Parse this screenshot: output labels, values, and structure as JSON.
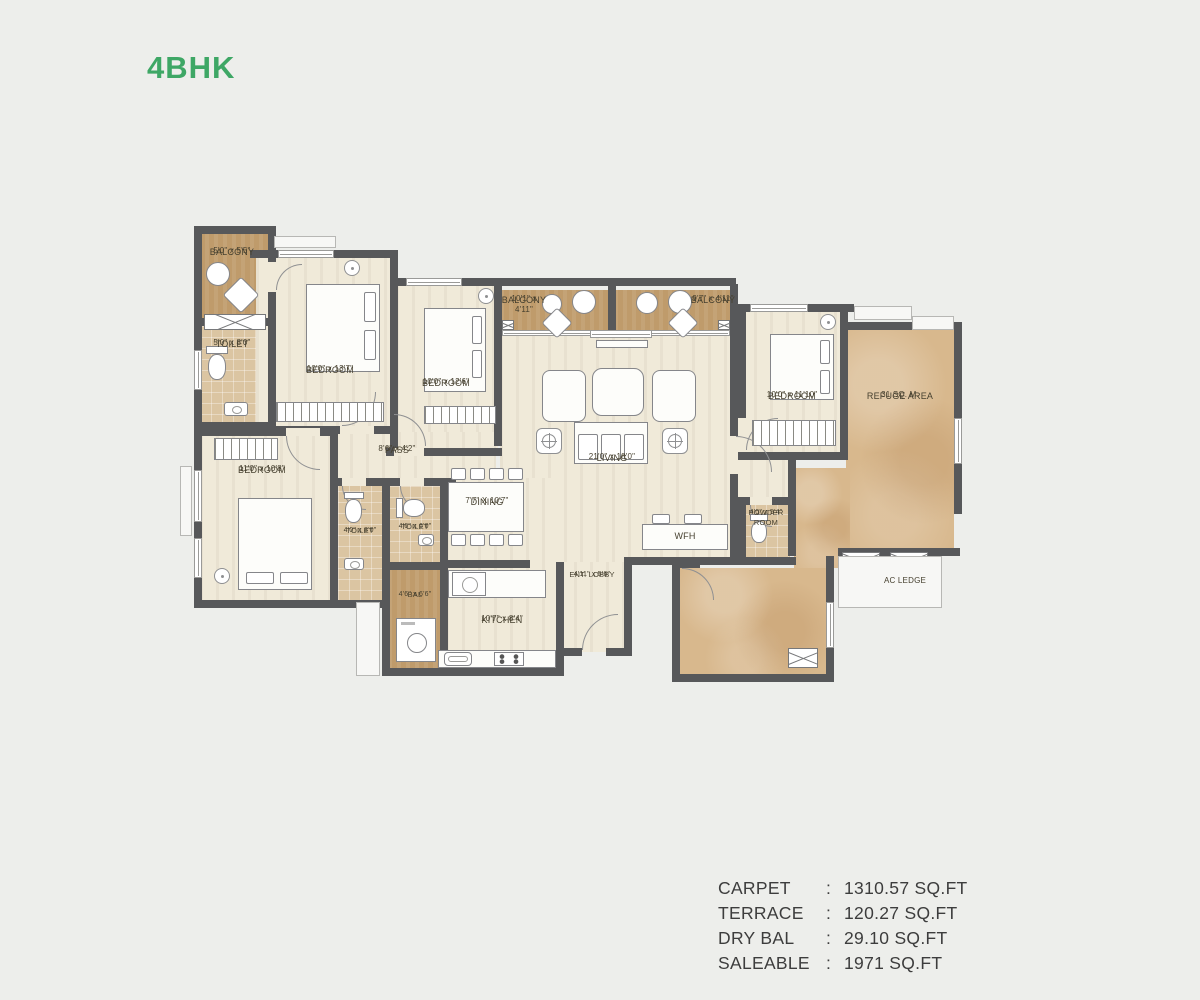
{
  "title": "4BHK",
  "colors": {
    "accent_green": "#3ea765",
    "wall": "#57585a",
    "floor_cream": "#f0ead9",
    "floor_balcony_tan": "#bf9b6b",
    "floor_toilet_tile": "#dbc5a2",
    "floor_refuge_marble": "#d8b88d",
    "background": "#edeeeb"
  },
  "rooms": {
    "balcony_tl": {
      "name": "BALCONY",
      "dims": "5'0\" x 5'5\""
    },
    "toilet_tl": {
      "name": "TOILET",
      "dims": "5'0\" x 8'0\""
    },
    "bedroom1": {
      "name": "BEDROOM",
      "dims": "10'0\" x 13'7\""
    },
    "bedroom2": {
      "name": "BEDROOM",
      "dims": "10'0\" x 12'6\""
    },
    "balcony_m1": {
      "name": "BALCONY",
      "dims": "10'1\" x 4'11\""
    },
    "balcony_m2": {
      "name": "BALCONY",
      "dims": "9'7\" x 4'11\""
    },
    "bedroom3": {
      "name": "BEDROOM",
      "dims": "10'0\" x 11'10\""
    },
    "refuge": {
      "name": "REFUGE AREA",
      "dims": "31 SQ. M."
    },
    "living": {
      "name": "LIVING",
      "dims": "21'0\" x 18'0\""
    },
    "pass": {
      "name": "PASS",
      "dims": "8'6\" x 4'2\""
    },
    "bedroom4": {
      "name": "BEDROOM",
      "dims": "11'0\" x 10'8\""
    },
    "toilet_l": {
      "name": "TOILET",
      "dims": "4'0\" x 8'0\""
    },
    "toilet_m": {
      "name": "TOILET",
      "dims": "4'6\" x 6'0\""
    },
    "dining": {
      "name": "DINING",
      "dims": "7'7\" X 10'7\""
    },
    "bal": {
      "name": "BAL",
      "dims": "4'6\" x 6'6\""
    },
    "kitchen": {
      "name": "KITCHEN",
      "dims": "10'7\" x 8'4\""
    },
    "ent_lobby": {
      "name": "ENT. LOBBY",
      "dims": "4'11\" x 5'6\""
    },
    "powder": {
      "name": "POWDER ROOM",
      "dims": "4'0\" x 5'4\""
    },
    "wfh": {
      "name": "WFH"
    },
    "ac_ledge": {
      "name": "AC LEDGE"
    }
  },
  "specs": [
    {
      "label": "CARPET",
      "sep": ":",
      "value": "1310.57 SQ.FT"
    },
    {
      "label": "TERRACE",
      "sep": ":",
      "value": "120.27 SQ.FT"
    },
    {
      "label": "DRY BAL",
      "sep": ":",
      "value": "29.10 SQ.FT"
    },
    {
      "label": "SALEABLE",
      "sep": ":",
      "value": "1971 SQ.FT"
    }
  ]
}
